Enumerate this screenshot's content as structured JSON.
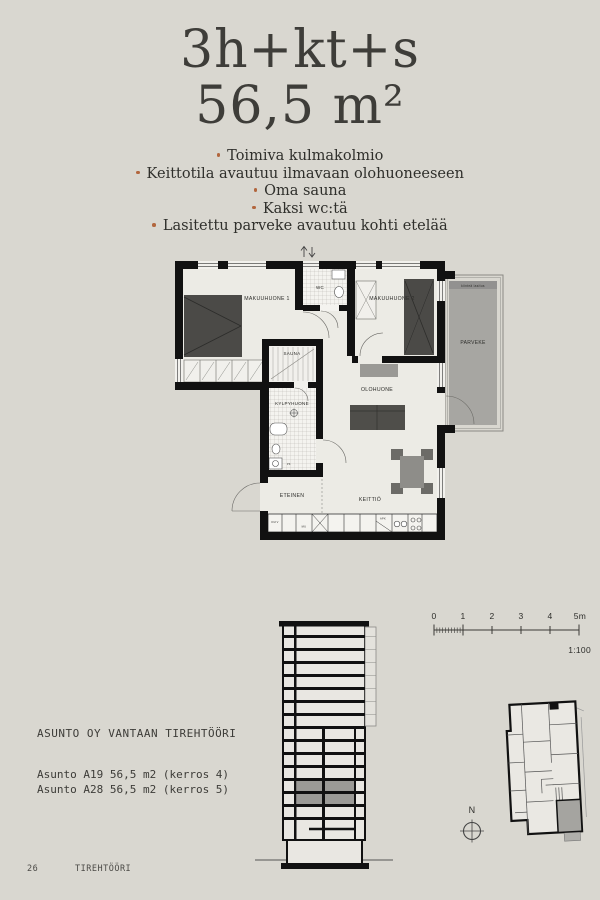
{
  "page": {
    "background": "#d9d7d0",
    "accent": "#b2663d",
    "ink": "#3e3d39"
  },
  "header": {
    "type": "3h+kt+s",
    "area": "56,5 m²"
  },
  "features": [
    "Toimiva kulmakolmio",
    "Keittotila avautuu ilmavaan olohuoneeseen",
    "Oma sauna",
    "Kaksi wc:tä",
    "Lasitettu parveke avautuu kohti etelää"
  ],
  "floorplan": {
    "rooms": {
      "bedroom1": "MAKUUHUONE 1",
      "bedroom2": "MAKUUHUONE 2",
      "wc": "WC",
      "sauna": "SAUNA",
      "bathroom": "KYLPYHUONE",
      "living": "OLOHUONE",
      "hall": "ETEINEN",
      "kitchen": "KEITTIÖ",
      "balcony": "PARVEKE"
    },
    "tiny": {
      "glazing": "kiinteä lasitus",
      "washer": "PK",
      "dryer": "KUIV",
      "microwave": "MU",
      "dishwasher": "APK"
    }
  },
  "scalebar": {
    "ticks": [
      "0",
      "1",
      "2",
      "3",
      "4",
      "5m"
    ],
    "ratio": "1:100"
  },
  "project": {
    "name": "ASUNTO OY VANTAAN TIREHTÖÖRI",
    "apartments": [
      "Asunto A19 56,5 m2 (kerros 4)",
      "Asunto A28 56,5 m2 (kerros 5)"
    ]
  },
  "compass": {
    "north_label": "N"
  },
  "footer": {
    "page_number": "26",
    "project_name": "TIREHTÖÖRI"
  }
}
